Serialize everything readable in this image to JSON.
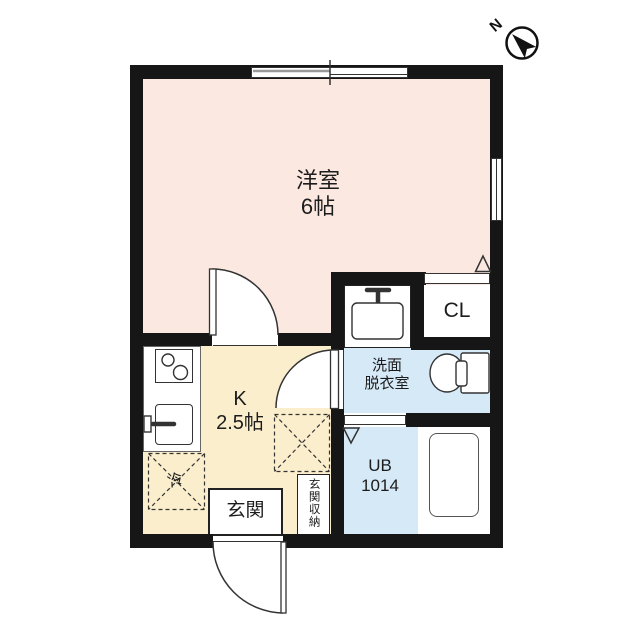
{
  "compass": {
    "label": "N"
  },
  "rooms": {
    "western_room": {
      "name": "洋室",
      "size": "6帖"
    },
    "kitchen": {
      "name": "K",
      "size": "2.5帖"
    },
    "washroom": {
      "name_line1": "洗面",
      "name_line2": "脱衣室"
    },
    "unit_bath": {
      "name": "UB",
      "size": "1014"
    },
    "closet": {
      "name": "CL"
    },
    "entrance": {
      "name": "玄関"
    },
    "entrance_storage": {
      "name": "玄関収納"
    },
    "refrigerator_space": {
      "name": "冷"
    }
  },
  "colors": {
    "western_room_floor": "#fbe9e1",
    "kitchen_floor": "#fbeecd",
    "wet_area_floor": "#d6e9f6",
    "wall": "#161616",
    "line": "#333333",
    "text": "#1c1c1c"
  }
}
